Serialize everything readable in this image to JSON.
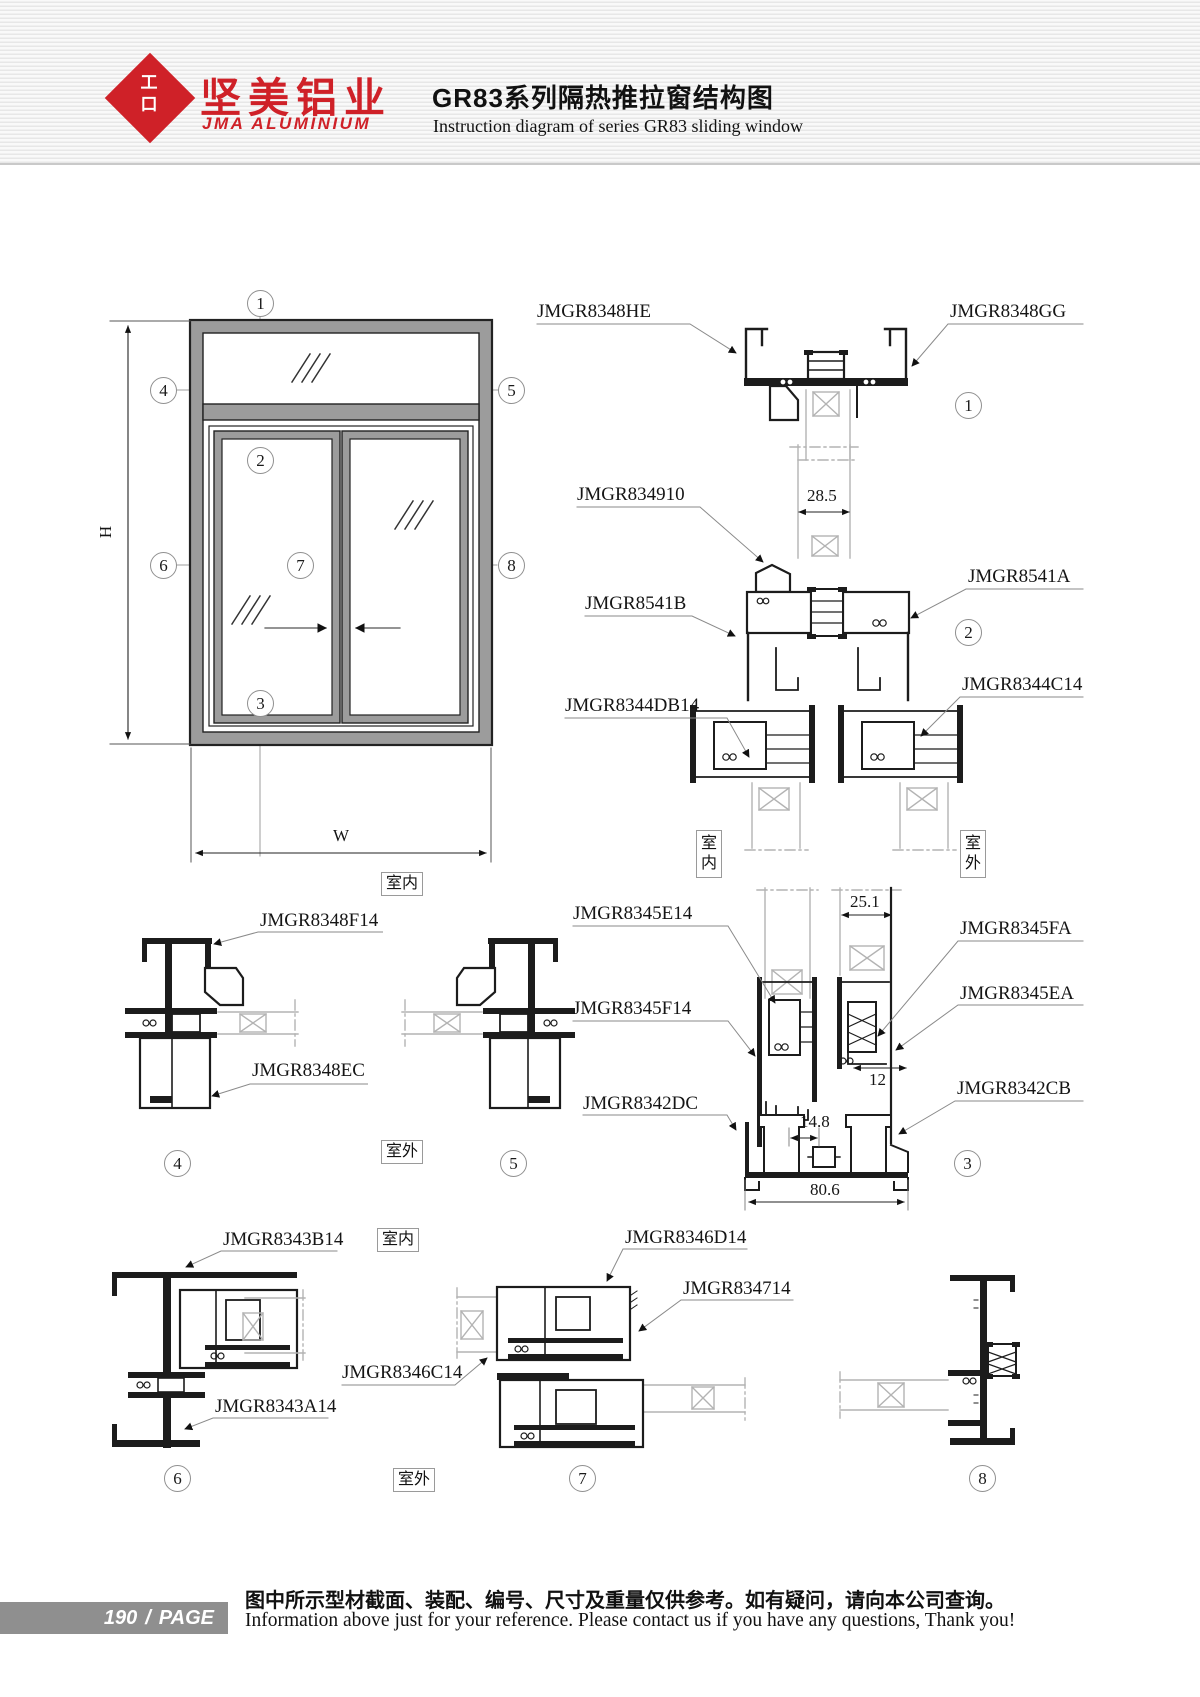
{
  "header": {
    "logo": {
      "glyph_top": "工",
      "glyph_bottom": "口",
      "brand_cn": "坚美铝业",
      "brand_en": "JMA ALUMINIUM"
    },
    "title_cn": "GR83系列隔热推拉窗结构图",
    "title_en": "Instruction diagram of series GR83 sliding window",
    "brand_color": "#cf2128"
  },
  "elevation": {
    "height_label": "H",
    "width_label": "W"
  },
  "room": {
    "indoor": "室内",
    "outdoor": "室外"
  },
  "details": {
    "d1": {
      "num": "1",
      "part_left": "JMGR8348HE",
      "part_right": "JMGR8348GG"
    },
    "d2": {
      "num": "2",
      "part_top": "JMGR834910",
      "part_left": "JMGR8541B",
      "part_right": "JMGR8541A",
      "part_bottom_left": "JMGR8344DB14",
      "part_bottom_right": "JMGR8344C14",
      "dim_glass": "28.5"
    },
    "d3": {
      "num": "3",
      "part_e14": "JMGR8345E14",
      "part_f14": "JMGR8345F14",
      "part_dc": "JMGR8342DC",
      "part_fa": "JMGR8345FA",
      "part_ea": "JMGR8345EA",
      "part_cb": "JMGR8342CB",
      "dim_glass": "25.1",
      "dim_gap": "12",
      "dim_track": "14.8",
      "dim_width": "80.6"
    },
    "d4": {
      "num": "4",
      "part_top": "JMGR8348F14",
      "part_bottom": "JMGR8348EC"
    },
    "d5": {
      "num": "5"
    },
    "d6": {
      "num": "6",
      "part_top": "JMGR8343B14",
      "part_bottom": "JMGR8343A14"
    },
    "d7": {
      "num": "7",
      "part_top": "JMGR8346D14",
      "part_right": "JMGR834714",
      "part_left": "JMGR8346C14"
    },
    "d8": {
      "num": "8"
    }
  },
  "footer": {
    "page_number": "190",
    "page_sep": "/",
    "page_label": "PAGE",
    "note_cn": "图中所示型材截面、装配、编号、尺寸及重量仅供参考。如有疑问，请向本公司查询。",
    "note_en": "Information above just for your reference. Please contact us if you have any questions, Thank you!"
  }
}
